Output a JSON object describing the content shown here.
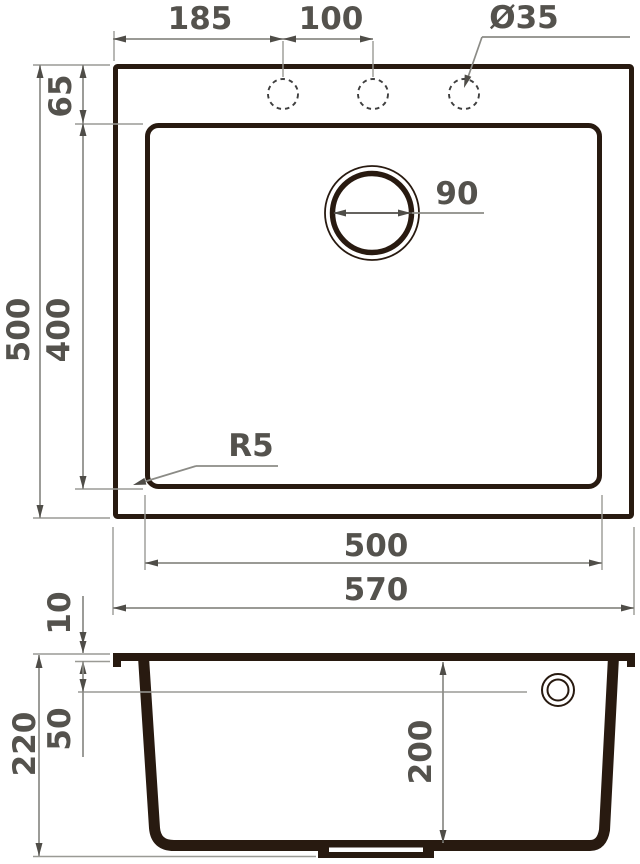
{
  "meta": {
    "drawing_type": "sink dimensional drawing",
    "background_color": "#ffffff",
    "outline_color": "#281a10",
    "dimension_color": "#8b8b86",
    "label_color": "#54524d"
  },
  "top_view": {
    "labels": {
      "hole_pitch_left": "185",
      "hole_pitch_center": "100",
      "hole_diameter": "Ø35",
      "top_offset": "65",
      "bowl_length": "400",
      "overall_length": "500",
      "drain_diameter": "90",
      "corner_radius": "R5",
      "bowl_width": "500",
      "overall_width": "570"
    }
  },
  "section_view": {
    "labels": {
      "rim_thickness": "10",
      "overflow_drop": "50",
      "overall_height": "220",
      "bowl_depth": "200"
    }
  }
}
